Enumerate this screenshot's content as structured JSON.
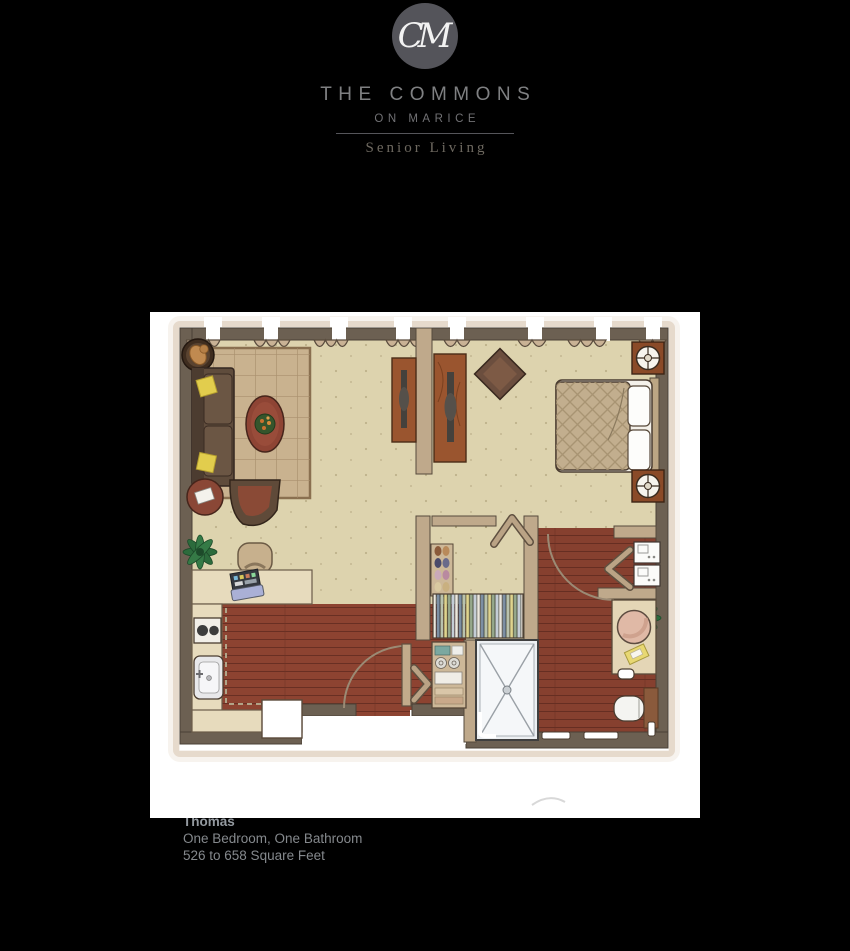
{
  "brand": {
    "monogram": "CM",
    "name_line1": "THE COMMONS",
    "name_line2": "ON MARICE",
    "tagline": "Senior Living"
  },
  "unit": {
    "name": "Thomas",
    "bed_bath": "One Bedroom, One Bathroom",
    "square_feet": "526 to 658 Square Feet"
  },
  "floorplan_icons": [
    "dog-bed-icon",
    "sofa-icon",
    "area-rug-icon",
    "coffee-table-icon",
    "side-table-icon",
    "accent-chair-icon",
    "plant-icon",
    "desk-icon",
    "desk-chair-icon",
    "laptop-icon",
    "cooktop-icon",
    "sink-icon",
    "refrigerator-icon",
    "entry-door-icon",
    "linen-shelf-icon",
    "bifold-door-icon",
    "shoe-rack-icon",
    "hanging-clothes-icon",
    "media-console-icon",
    "tv-icon",
    "corner-chair-icon",
    "bed-icon",
    "nightstand-icon",
    "table-lamp-icon",
    "washer-dryer-icon",
    "vanity-sink-icon",
    "toilet-icon",
    "shower-icon",
    "window-valance-icon"
  ],
  "colors": {
    "page_bg": "#000000",
    "card_bg": "#ffffff",
    "wall": "#6c6052",
    "partition": "#bfa98b",
    "carpet": "#ddd3ae",
    "wood": "#8d4331",
    "counter": "#e7dbbd",
    "valance": "#c9b295",
    "rug": "#c9b28f",
    "sofa_brown": "#5f4c3c",
    "accent_red": "#8e4434",
    "plant_green": "#2c6b3c",
    "logo_circle": "#54545a",
    "brand_text": "#7f8082",
    "tagline_text": "#6e6960",
    "caption_title": "#949aa0",
    "caption_text": "#85898d"
  }
}
